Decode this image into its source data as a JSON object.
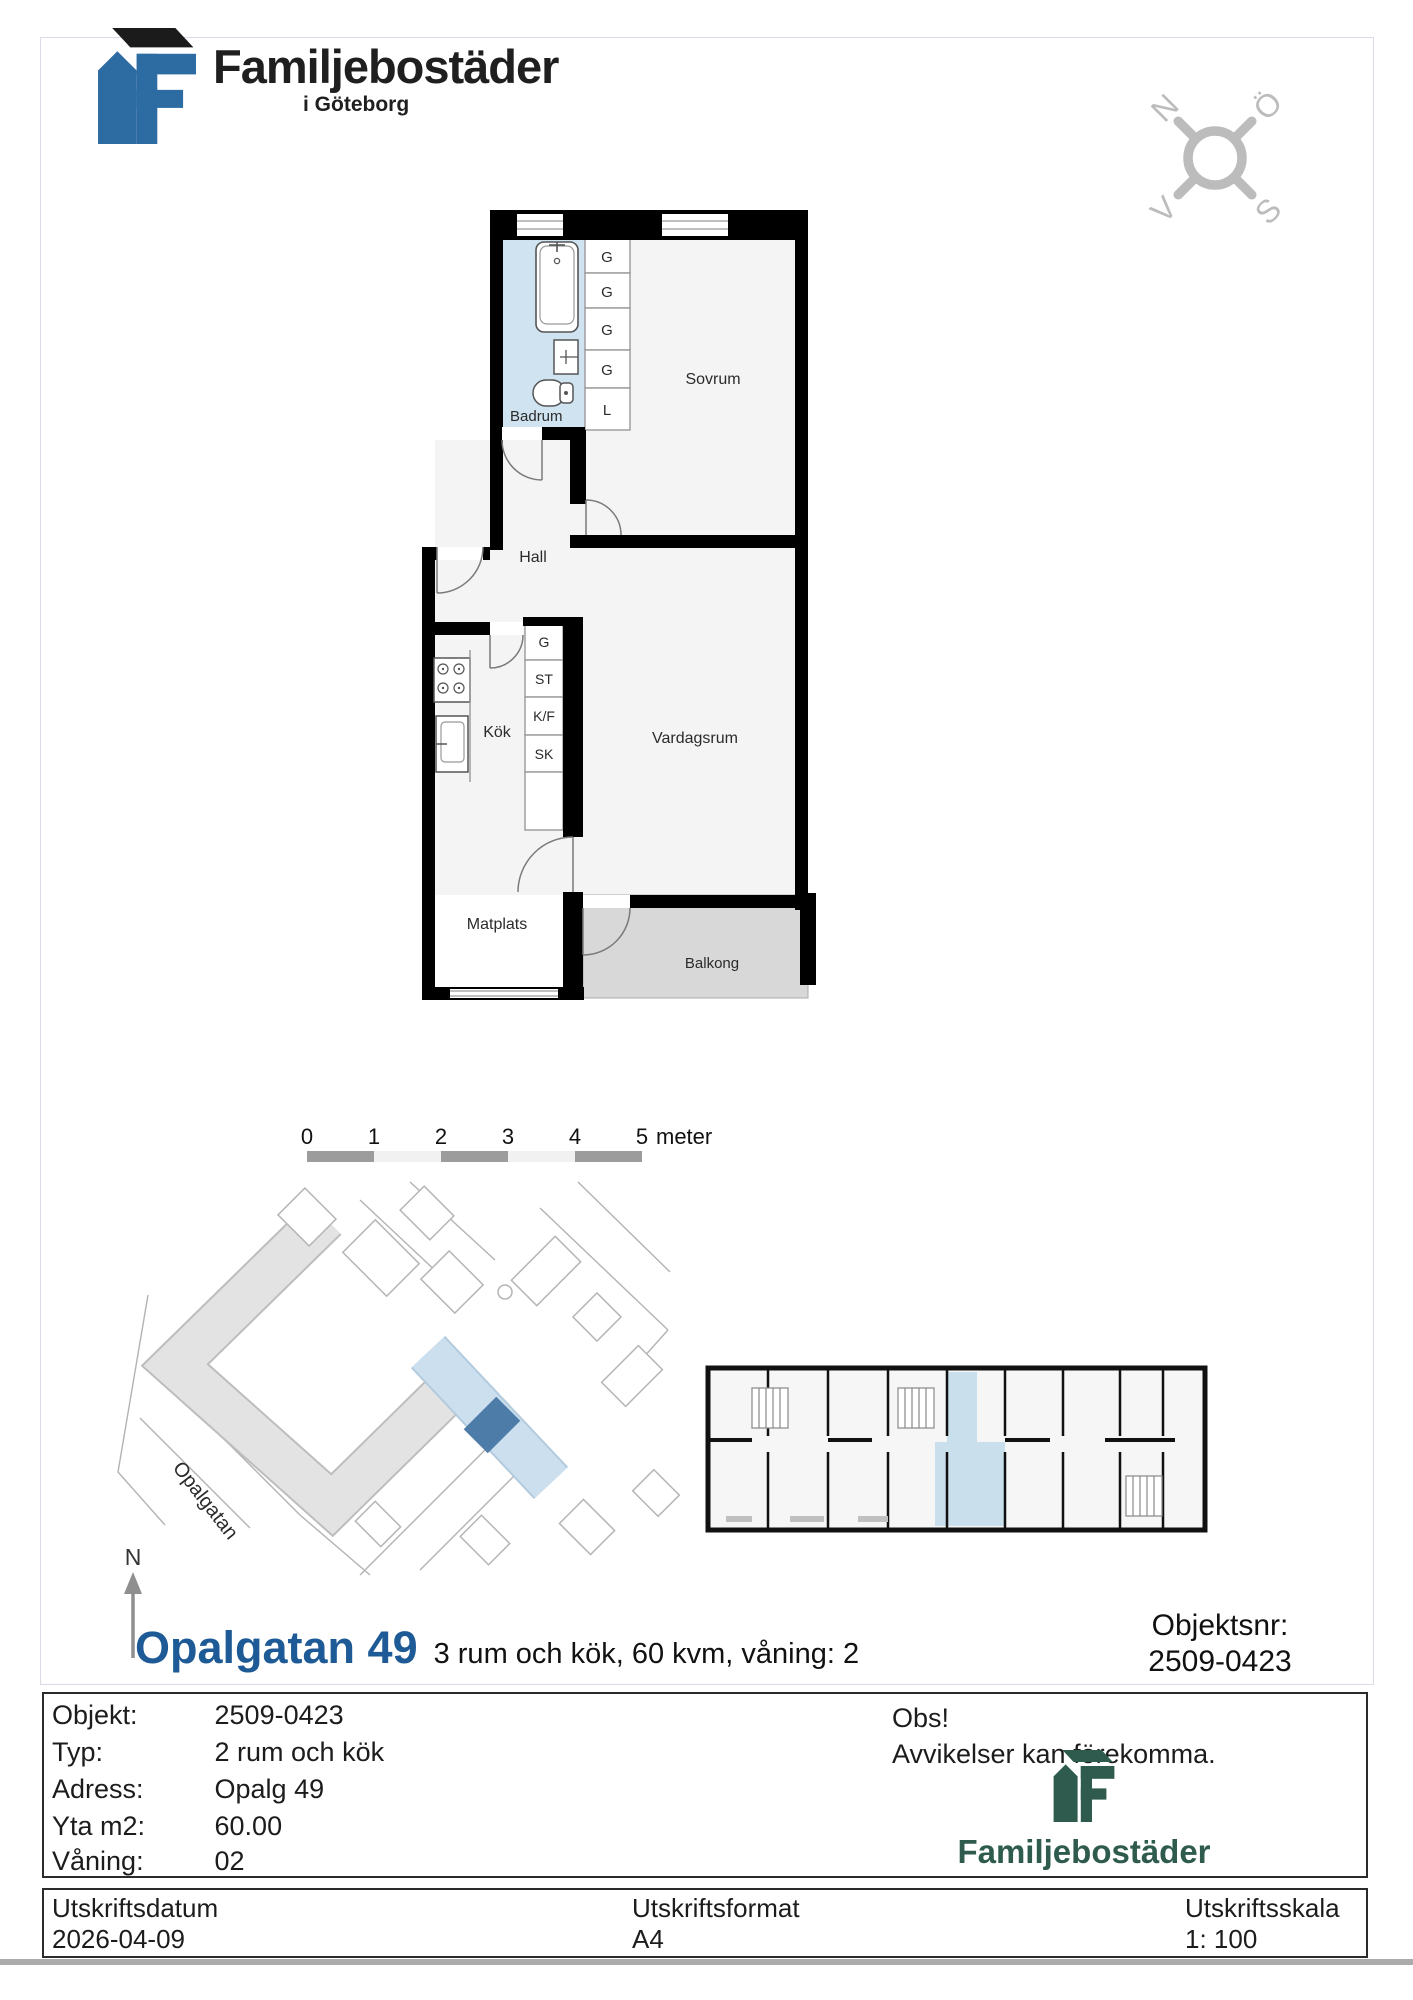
{
  "header": {
    "brand": "Familjebostäder",
    "brand_sub": "i Göteborg"
  },
  "compass": {
    "n": "N",
    "e": "Ö",
    "s": "S",
    "w": "V"
  },
  "plan": {
    "rooms": {
      "badrum": "Badrum",
      "sovrum": "Sovrum",
      "hall": "Hall",
      "kok": "Kök",
      "vardagsrum": "Vardagsrum",
      "matplats": "Matplats",
      "balkong": "Balkong"
    },
    "closets_upper": [
      "G",
      "G",
      "G",
      "G",
      "L"
    ],
    "closets_lower": [
      "G",
      "ST",
      "K/F",
      "SK"
    ]
  },
  "scalebar": {
    "ticks": [
      "0",
      "1",
      "2",
      "3",
      "4",
      "5"
    ],
    "unit": "meter"
  },
  "siteplan": {
    "street": "Opalgatan",
    "north": "N"
  },
  "title": {
    "main": "Opalgatan 49",
    "subtitle": "3 rum och kök, 60 kvm, våning: 2"
  },
  "objektsnr": {
    "label": "Objektsnr:",
    "value": "2509-0423"
  },
  "info": {
    "rows": [
      {
        "label": "Objekt:",
        "value": "2509-0423"
      },
      {
        "label": "Typ:",
        "value": "2 rum och kök"
      },
      {
        "label": "Adress:",
        "value": "Opalg 49"
      },
      {
        "label": "Yta m2:",
        "value": "60.00"
      },
      {
        "label": "Våning:",
        "value": "02"
      }
    ],
    "obs_title": "Obs!",
    "obs_text": "Avvikelser kan förekomma.",
    "brand": "Familjebostäder"
  },
  "footer": {
    "date_label": "Utskriftsdatum",
    "date_value": "2026-04-09",
    "format_label": "Utskriftsformat",
    "format_value": "A4",
    "scale_label": "Utskriftsskala",
    "scale_value": "1: 100"
  },
  "colors": {
    "title_blue": "#1d5a96",
    "brand_green": "#2e5b4d",
    "logo_blue": "#2d6ba3",
    "badrum_fill": "#cfe3f1",
    "balkong_fill": "#d8d8d8",
    "room_fill": "#f4f4f4",
    "highlight_blue": "#c9dfeb",
    "unit_blue": "#4c7ca7"
  }
}
